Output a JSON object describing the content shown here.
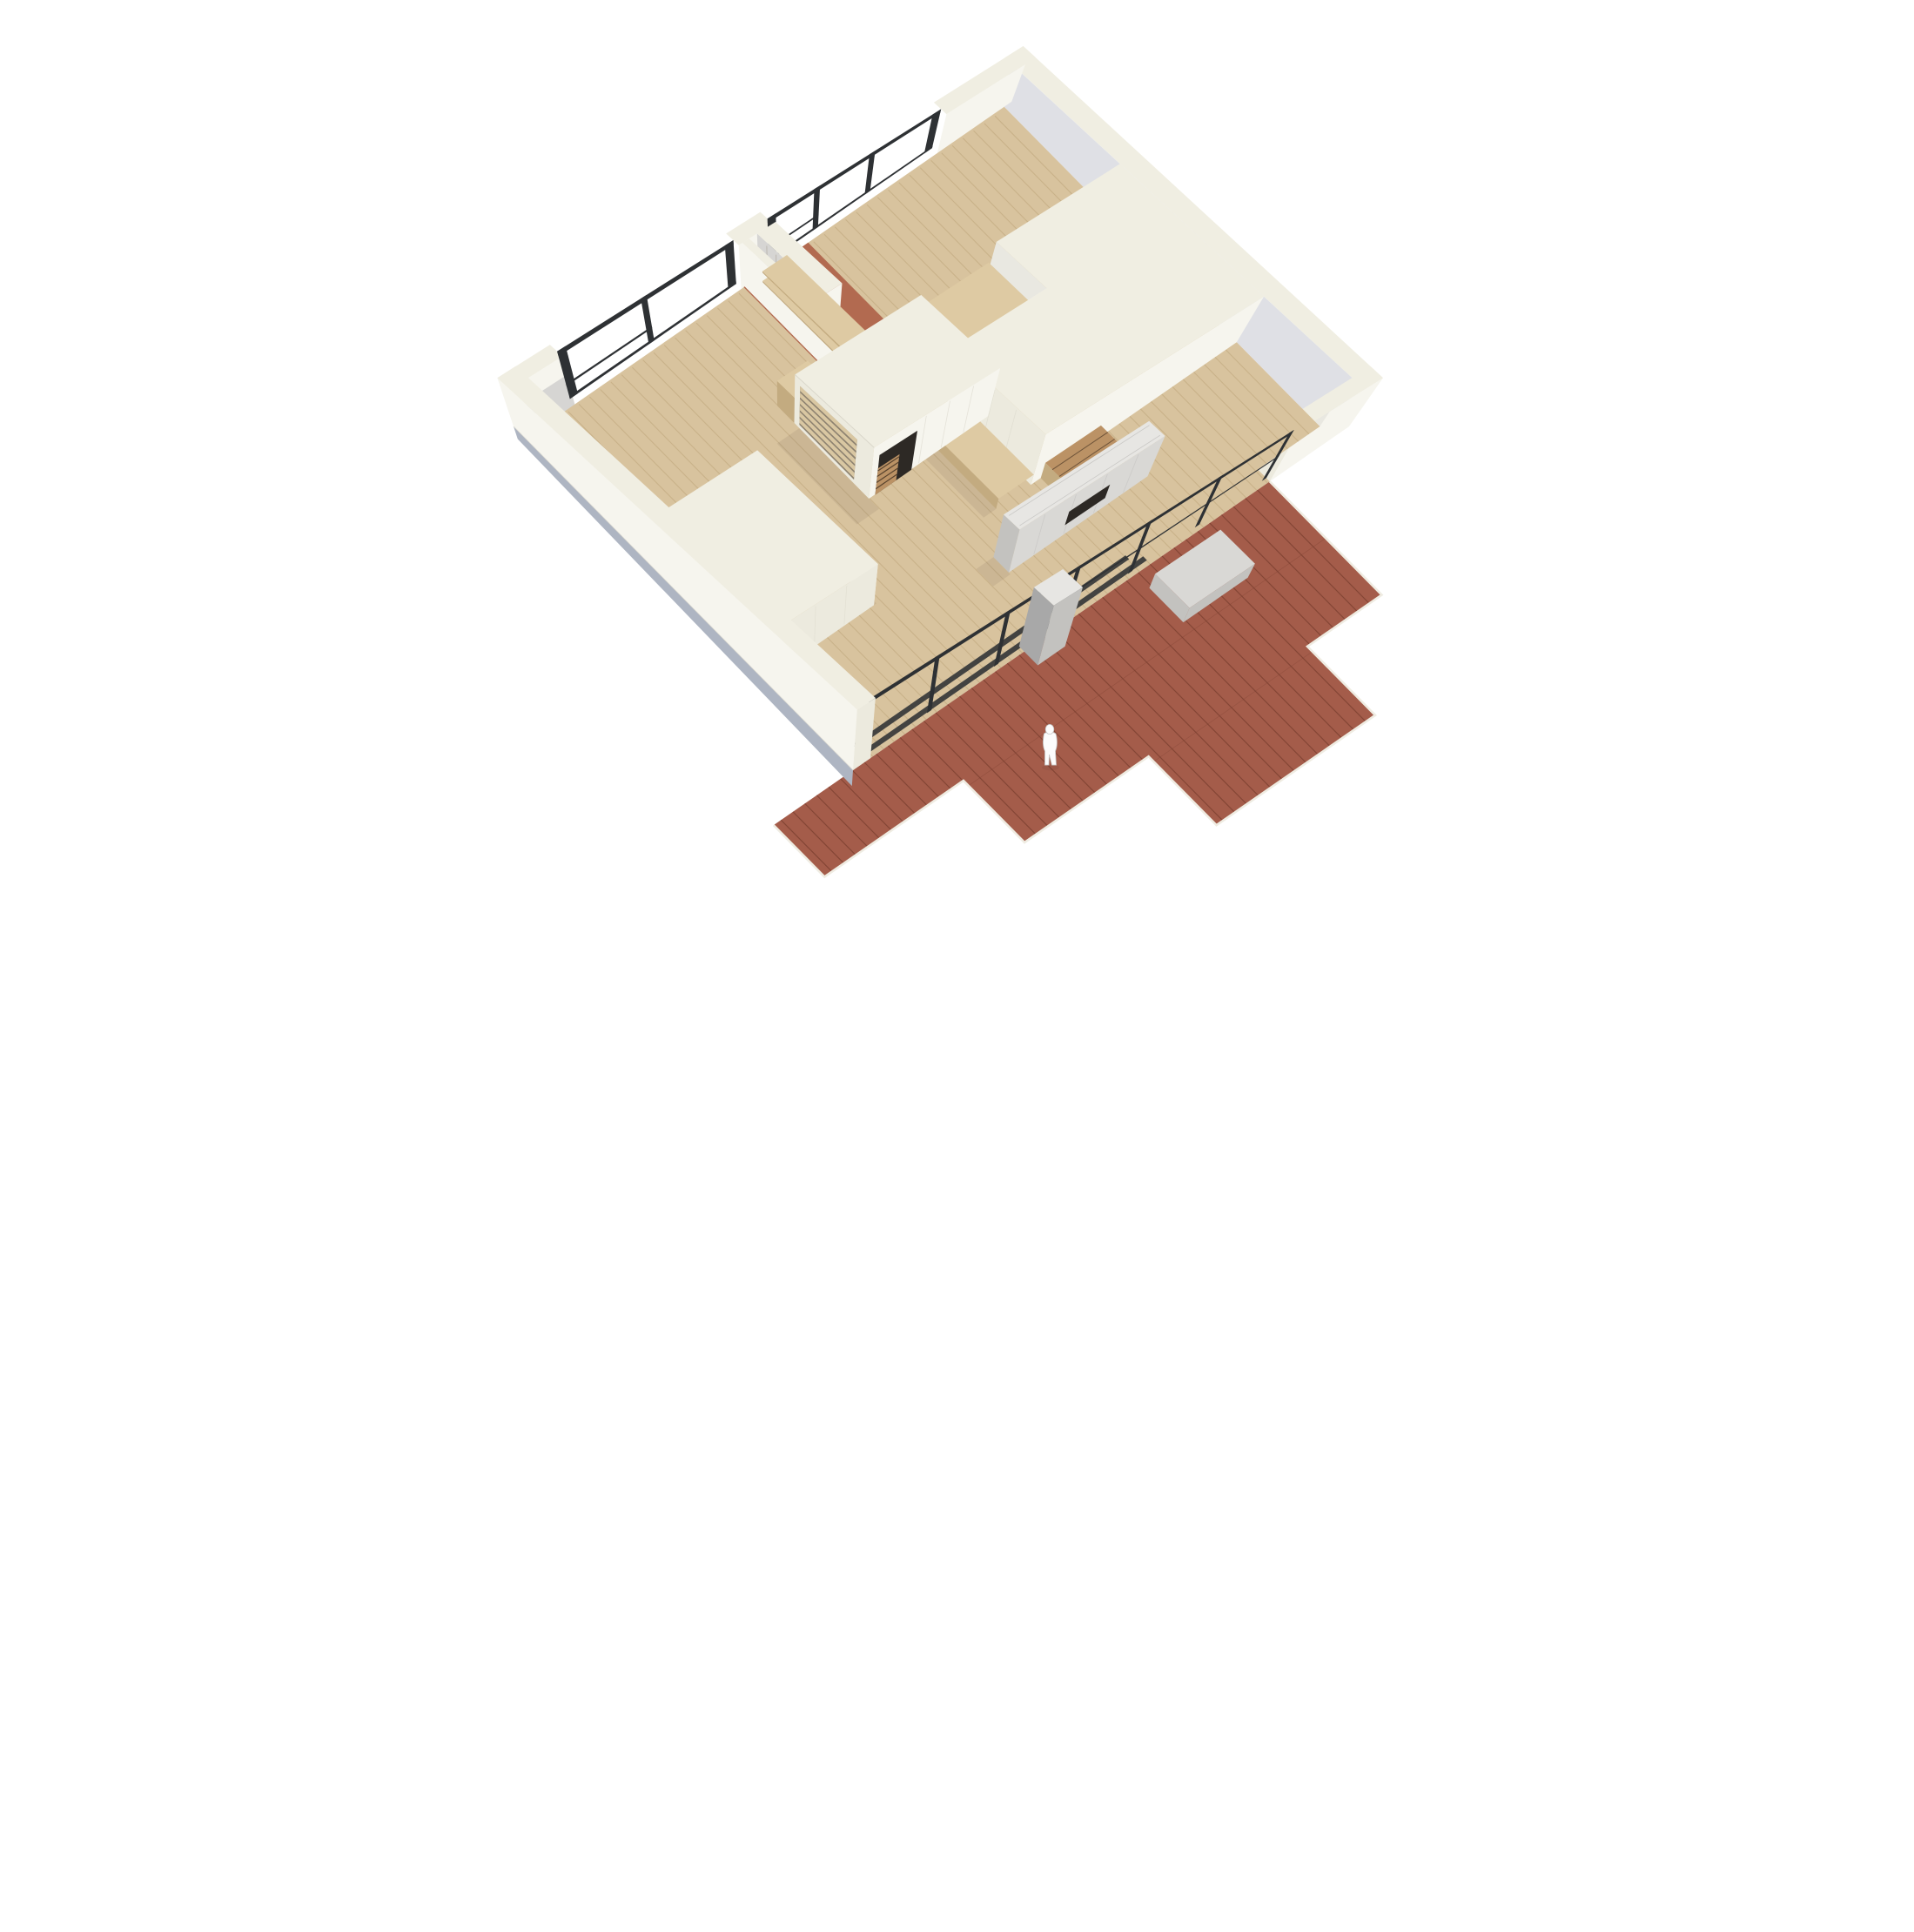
{
  "meta": {
    "title": "Photograph of a white architectural scale model of a single-storey apartment seen from above, with light wood interior floors, black framed glazing, a red-brown timber deck and a white scale figure",
    "type": "photograph-of-physical-model"
  },
  "palette": {
    "bg": "#ffffff",
    "wallTop": "#f0eee2",
    "wallLit": "#f6f5ee",
    "wallFace": "#eceade",
    "wallShade": "#dfe0e5",
    "wallShade2": "#e9e8e1",
    "grayPanel": "#d6d5d3",
    "baseEdge": "#aeb5c2",
    "wood": "#d8c39e",
    "woodLine": "#c5ae85",
    "terracotta": "#b26a50",
    "deck": "#a45c4a",
    "deckLine": "#7f4233",
    "deckEdge": "#efece2",
    "frameBlack": "#2e3134",
    "ply": "#decaa3",
    "plyDark": "#c3ab80",
    "louver": "#d9c7a2",
    "louverGap": "#8d8270",
    "stairWood": "#bb9265",
    "stairDark": "#4e3b28",
    "fireGray": "#d9d8d5",
    "fireGrayTop": "#e7e6e3",
    "fireGraySide": "#c3c2bf",
    "fireOpening": "#2d2925",
    "pillarGray": "#a8a8a8",
    "figure": "#fcfcfc",
    "figureShade": "#c6c6c6",
    "seam": "#d3d0c4",
    "shadow": "rgba(45,40,35,0.08)"
  },
  "scene": {
    "description": "Top-down oblique view of a card-and-wood model: square plan, white walls with black steel window frames on two sides, interior pale wood plank floor, terracotta entry floor, central white stair-core box with louvered side, freestanding grey fireplace wall, built-in plywood shelving, two white furniture blocks, full-width glazed wall opening onto a stepped red-brown plank deck with a grey bench, grey chimney pillar and a tiny white human scale figure. Blue-grey base board edge visible at lower left.",
    "elements": [
      {
        "name": "ne-wall",
        "label": "Back-right white wall"
      },
      {
        "name": "nw-wall",
        "label": "Back-left wall with two black-framed windows"
      },
      {
        "name": "right-wall",
        "label": "Right white wall segment"
      },
      {
        "name": "interior-floor",
        "label": "Pale wood plank floor"
      },
      {
        "name": "entry-terracotta-floor",
        "label": "Terracotta entry floor"
      },
      {
        "name": "deck",
        "label": "Red-brown timber deck with stepped edge"
      },
      {
        "name": "top-right-room-block",
        "label": "Flat-roofed room block with shelf niche and plywood bench"
      },
      {
        "name": "partition-walls",
        "label": "Entry partition walls with slatted grey panel"
      },
      {
        "name": "entry-shelving",
        "label": "Plywood shelving and cubby unit"
      },
      {
        "name": "west-room-block",
        "label": "White furniture block in left room"
      },
      {
        "name": "core-box",
        "label": "Central stair-core box with louvered face and stair opening"
      },
      {
        "name": "stair",
        "label": "Timber stair flight"
      },
      {
        "name": "fireplace-wall",
        "label": "Freestanding grey fireplace wall with dark opening"
      },
      {
        "name": "glazed-wall",
        "label": "Black-framed glazed wall with floor tracks"
      },
      {
        "name": "chimney-pillar",
        "label": "Grey pillar at glazed wall"
      },
      {
        "name": "deck-bench",
        "label": "Grey bench on deck"
      },
      {
        "name": "sw-wall",
        "label": "Front-left white wall with blue-grey base edge"
      },
      {
        "name": "scale-figure",
        "label": "White human scale figure on deck"
      }
    ]
  }
}
